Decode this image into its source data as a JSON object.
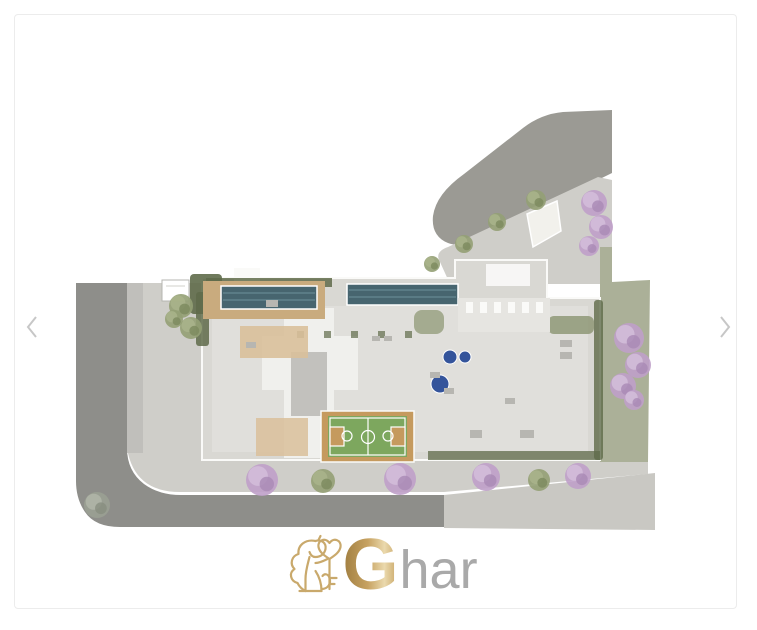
{
  "window": {
    "background": "#ffffff"
  },
  "card": {
    "border_color": "#ececec",
    "background": "#ffffff"
  },
  "carousel": {
    "prev_icon": "chevron-left",
    "next_icon": "chevron-right",
    "arrow_color": "#c7c7c7"
  },
  "logo": {
    "g": "G",
    "rest": "har",
    "gold_dark": "#9f7d40",
    "gold_mid": "#c7a261",
    "gold_light": "#ead9ad",
    "icon_stroke": "#c9a96c",
    "text_color": "#a9a9a9"
  },
  "plan": {
    "description": "aerial-ground-floor-site-plan",
    "colors": {
      "road": "#9b9a94",
      "road_dark": "#8e8e8a",
      "road_light": "#c9c8c3",
      "sidewalk": "#cfcec9",
      "driveway": "#c0bfbb",
      "lane_line": "#dedbc0",
      "crossing": "#f2f1ec",
      "grass": "#abb098",
      "hedge": "#5f6b4a",
      "bush": "#8a9471",
      "slab": "#d9d8d3",
      "floor": "#e6e5e1",
      "lobby": "#f0f0ed",
      "core": "#c2c1bd",
      "wall": "#fafaf8",
      "deck_wood": "#c9ab7e",
      "room_wood": "#d9c09a",
      "pool": "#47656f",
      "pool_lane": "#6e919b",
      "spa": "#34549b",
      "court_border": "#c59a5e",
      "court_green": "#7da75e",
      "court_line": "#ffffff",
      "furniture": "#b7b6b1",
      "truck": "#ffffff"
    },
    "tree_shades": {
      "purple": {
        "base": "#bfa0c9",
        "light": "#d4bedb",
        "dark": "#a98ab5"
      },
      "olive": {
        "base": "#93a074",
        "light": "#a9b48b",
        "dark": "#7c8a5e"
      },
      "gray": {
        "base": "#9aa092",
        "light": "#b0b5a8",
        "dark": "#878d7f"
      }
    },
    "trees": [
      {
        "x": 594,
        "y": 203,
        "r": 13,
        "type": "purple"
      },
      {
        "x": 601,
        "y": 227,
        "r": 12,
        "type": "purple"
      },
      {
        "x": 589,
        "y": 246,
        "r": 10,
        "type": "purple"
      },
      {
        "x": 629,
        "y": 338,
        "r": 15,
        "type": "purple"
      },
      {
        "x": 638,
        "y": 365,
        "r": 13,
        "type": "purple"
      },
      {
        "x": 623,
        "y": 386,
        "r": 13,
        "type": "purple"
      },
      {
        "x": 634,
        "y": 400,
        "r": 10,
        "type": "purple"
      },
      {
        "x": 262,
        "y": 480,
        "r": 16,
        "type": "purple"
      },
      {
        "x": 400,
        "y": 479,
        "r": 16,
        "type": "purple"
      },
      {
        "x": 486,
        "y": 477,
        "r": 14,
        "type": "purple"
      },
      {
        "x": 578,
        "y": 476,
        "r": 13,
        "type": "purple"
      },
      {
        "x": 536,
        "y": 200,
        "r": 10,
        "type": "olive"
      },
      {
        "x": 497,
        "y": 222,
        "r": 9,
        "type": "olive"
      },
      {
        "x": 464,
        "y": 244,
        "r": 9,
        "type": "olive"
      },
      {
        "x": 432,
        "y": 264,
        "r": 8,
        "type": "olive"
      },
      {
        "x": 181,
        "y": 306,
        "r": 12,
        "type": "olive"
      },
      {
        "x": 191,
        "y": 328,
        "r": 11,
        "type": "olive"
      },
      {
        "x": 174,
        "y": 319,
        "r": 9,
        "type": "olive"
      },
      {
        "x": 323,
        "y": 481,
        "r": 12,
        "type": "olive"
      },
      {
        "x": 539,
        "y": 480,
        "r": 11,
        "type": "olive"
      },
      {
        "x": 97,
        "y": 505,
        "r": 13,
        "type": "gray"
      }
    ]
  }
}
